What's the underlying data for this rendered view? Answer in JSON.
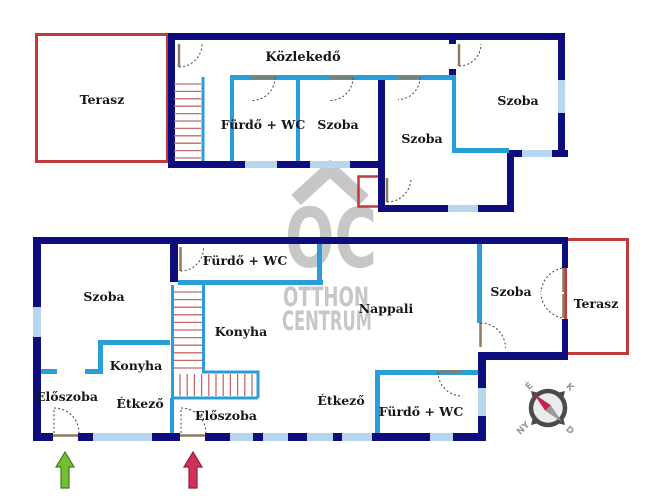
{
  "rooms": {
    "upper": {
      "terasz": "Terasz",
      "kozlekedo": "Közlekedő",
      "furdo": "Fürdő + WC",
      "szoba_a": "Szoba",
      "szoba_b": "Szoba",
      "szoba_c": "Szoba"
    },
    "lower": {
      "furdo_top": "Fürdő + WC",
      "szoba_a": "Szoba",
      "konyha_a": "Konyha",
      "eloszoba_a": "Előszoba",
      "etkezo_a": "Étkező",
      "konyha_b": "Konyha",
      "eloszoba_b": "Előszoba",
      "nappali": "Nappali",
      "etkezo_b": "Étkező",
      "furdo_b": "Fürdő + WC",
      "szoba_b": "Szoba",
      "terasz": "Terasz"
    }
  },
  "watermark": {
    "monogram": "OC",
    "line1": "OTTHON",
    "line2": "CENTRUM"
  },
  "compass": {
    "north": "É",
    "east": "K",
    "west": "NY",
    "south": "D"
  },
  "colors": {
    "outer_wall": "#0d0d7d",
    "partition_wall": "#2a9ed8",
    "window": "#b9d7ec",
    "terrace_outline": "#bf3a3a",
    "stairs": "#c4686a",
    "door_panel": "#8c7b60",
    "watermark": "#c7c7c7",
    "arrow_green": "#76bf34",
    "arrow_red": "#d23058",
    "label_text": "#16161e"
  }
}
